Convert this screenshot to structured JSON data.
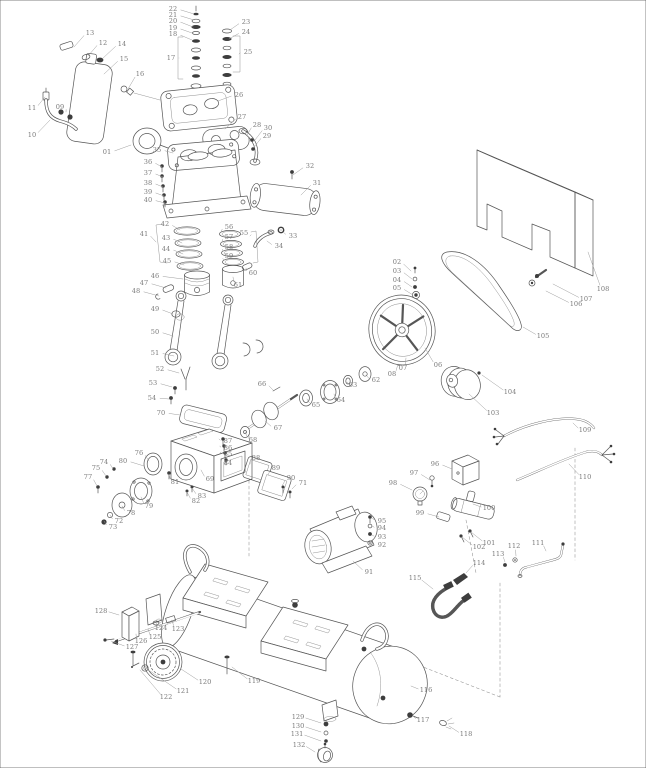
{
  "diagram": {
    "type": "exploded-parts-diagram",
    "part_count": 132
  },
  "style": {
    "line": "#565656",
    "label": "#7b7b7b",
    "leader": "#9d9d9d",
    "background": "#ffffff"
  },
  "parts": [
    {
      "n": "01",
      "x": 107,
      "y": 152,
      "tx": 131,
      "ty": 145
    },
    {
      "n": "02",
      "x": 397,
      "y": 262,
      "tx": 411,
      "ty": 271
    },
    {
      "n": "03",
      "x": 397,
      "y": 271,
      "tx": 412,
      "ty": 279
    },
    {
      "n": "04",
      "x": 397,
      "y": 280,
      "tx": 412,
      "ty": 287
    },
    {
      "n": "05",
      "x": 397,
      "y": 288,
      "tx": 413,
      "ty": 295
    },
    {
      "n": "06",
      "x": 438,
      "y": 365,
      "tx": 425,
      "ty": 348
    },
    {
      "n": "07",
      "x": 403,
      "y": 368,
      "tx": 406,
      "ty": 358
    },
    {
      "n": "08",
      "x": 392,
      "y": 374,
      "tx": 398,
      "ty": 364
    },
    {
      "n": "09",
      "x": 60,
      "y": 107,
      "tx": 66,
      "ty": 112
    },
    {
      "n": "10",
      "x": 32,
      "y": 135,
      "tx": 50,
      "ty": 120
    },
    {
      "n": "11",
      "x": 32,
      "y": 108,
      "tx": 45,
      "ty": 97
    },
    {
      "n": "12",
      "x": 103,
      "y": 43,
      "tx": 88,
      "ty": 56
    },
    {
      "n": "13",
      "x": 90,
      "y": 33,
      "tx": 74,
      "ty": 47
    },
    {
      "n": "14",
      "x": 122,
      "y": 44,
      "tx": 102,
      "ty": 59
    },
    {
      "n": "15",
      "x": 124,
      "y": 59,
      "tx": 104,
      "ty": 74
    },
    {
      "n": "16",
      "x": 140,
      "y": 74,
      "tx": 128,
      "ty": 89
    },
    {
      "n": "17",
      "x": 171,
      "y": 58,
      "tx": 179,
      "ty": 58
    },
    {
      "n": "18",
      "x": 173,
      "y": 34,
      "tx": 192,
      "ty": 40
    },
    {
      "n": "19",
      "x": 173,
      "y": 28,
      "tx": 192,
      "ty": 33
    },
    {
      "n": "20",
      "x": 173,
      "y": 21,
      "tx": 193,
      "ty": 27
    },
    {
      "n": "21",
      "x": 173,
      "y": 15,
      "tx": 194,
      "ty": 20
    },
    {
      "n": "22",
      "x": 173,
      "y": 9,
      "tx": 194,
      "ty": 14
    },
    {
      "n": "23",
      "x": 246,
      "y": 22,
      "tx": 230,
      "ty": 30
    },
    {
      "n": "24",
      "x": 246,
      "y": 32,
      "tx": 229,
      "ty": 39
    },
    {
      "n": "25",
      "x": 248,
      "y": 52,
      "tx": 239,
      "ty": 54
    },
    {
      "n": "26",
      "x": 239,
      "y": 95,
      "tx": 218,
      "ty": 101
    },
    {
      "n": "27",
      "x": 242,
      "y": 117,
      "tx": 225,
      "ty": 129
    },
    {
      "n": "28",
      "x": 257,
      "y": 125,
      "tx": 247,
      "ty": 135
    },
    {
      "n": "29",
      "x": 267,
      "y": 136,
      "tx": 254,
      "ty": 147
    },
    {
      "n": "30",
      "x": 268,
      "y": 128,
      "tx": 255,
      "ty": 140
    },
    {
      "n": "31",
      "x": 317,
      "y": 183,
      "tx": 301,
      "ty": 195
    },
    {
      "n": "32",
      "x": 310,
      "y": 166,
      "tx": 293,
      "ty": 175
    },
    {
      "n": "33",
      "x": 293,
      "y": 236,
      "tx": 282,
      "ty": 231
    },
    {
      "n": "34",
      "x": 279,
      "y": 246,
      "tx": 267,
      "ty": 241
    },
    {
      "n": "35",
      "x": 157,
      "y": 150,
      "tx": 173,
      "ty": 153
    },
    {
      "n": "36",
      "x": 148,
      "y": 162,
      "tx": 162,
      "ty": 167
    },
    {
      "n": "37",
      "x": 148,
      "y": 173,
      "tx": 163,
      "ty": 177
    },
    {
      "n": "38",
      "x": 148,
      "y": 183,
      "tx": 163,
      "ty": 187
    },
    {
      "n": "39",
      "x": 148,
      "y": 192,
      "tx": 164,
      "ty": 196
    },
    {
      "n": "40",
      "x": 148,
      "y": 200,
      "tx": 165,
      "ty": 203
    },
    {
      "n": "41",
      "x": 144,
      "y": 234,
      "tx": 156,
      "ty": 242
    },
    {
      "n": "42",
      "x": 165,
      "y": 224,
      "tx": 180,
      "ty": 230
    },
    {
      "n": "43",
      "x": 166,
      "y": 238,
      "tx": 182,
      "ty": 243
    },
    {
      "n": "44",
      "x": 166,
      "y": 249,
      "tx": 183,
      "ty": 254
    },
    {
      "n": "45",
      "x": 167,
      "y": 261,
      "tx": 184,
      "ty": 265
    },
    {
      "n": "46",
      "x": 155,
      "y": 276,
      "tx": 183,
      "ty": 279
    },
    {
      "n": "47",
      "x": 144,
      "y": 283,
      "tx": 166,
      "ty": 288
    },
    {
      "n": "48",
      "x": 136,
      "y": 291,
      "tx": 159,
      "ty": 296
    },
    {
      "n": "49",
      "x": 155,
      "y": 309,
      "tx": 173,
      "ty": 314
    },
    {
      "n": "50",
      "x": 155,
      "y": 332,
      "tx": 173,
      "ty": 336
    },
    {
      "n": "51",
      "x": 155,
      "y": 353,
      "tx": 174,
      "ty": 356
    },
    {
      "n": "52",
      "x": 160,
      "y": 369,
      "tx": 179,
      "ty": 373
    },
    {
      "n": "53",
      "x": 153,
      "y": 383,
      "tx": 172,
      "ty": 387
    },
    {
      "n": "54",
      "x": 152,
      "y": 398,
      "tx": 169,
      "ty": 399
    },
    {
      "n": "55",
      "x": 244,
      "y": 233,
      "tx": 250,
      "ty": 236
    },
    {
      "n": "56",
      "x": 229,
      "y": 227,
      "tx": 221,
      "ty": 232
    },
    {
      "n": "57",
      "x": 229,
      "y": 237,
      "tx": 222,
      "ty": 242
    },
    {
      "n": "58",
      "x": 229,
      "y": 247,
      "tx": 223,
      "ty": 251
    },
    {
      "n": "59",
      "x": 229,
      "y": 256,
      "tx": 224,
      "ty": 260
    },
    {
      "n": "60",
      "x": 253,
      "y": 273,
      "tx": 246,
      "ty": 268
    },
    {
      "n": "61",
      "x": 238,
      "y": 285,
      "tx": 233,
      "ty": 277
    },
    {
      "n": "62",
      "x": 376,
      "y": 380,
      "tx": 366,
      "ty": 375
    },
    {
      "n": "63",
      "x": 353,
      "y": 385,
      "tx": 348,
      "ty": 382
    },
    {
      "n": "64",
      "x": 341,
      "y": 400,
      "tx": 334,
      "ty": 394
    },
    {
      "n": "65",
      "x": 316,
      "y": 405,
      "tx": 307,
      "ty": 399
    },
    {
      "n": "66",
      "x": 262,
      "y": 384,
      "tx": 273,
      "ty": 390
    },
    {
      "n": "67",
      "x": 278,
      "y": 428,
      "tx": 265,
      "ty": 421
    },
    {
      "n": "68",
      "x": 253,
      "y": 440,
      "tx": 245,
      "ty": 432
    },
    {
      "n": "69",
      "x": 210,
      "y": 479,
      "tx": 201,
      "ty": 470
    },
    {
      "n": "70",
      "x": 161,
      "y": 413,
      "tx": 180,
      "ty": 415
    },
    {
      "n": "71",
      "x": 303,
      "y": 483,
      "tx": 292,
      "ty": 489
    },
    {
      "n": "72",
      "x": 119,
      "y": 521,
      "tx": 110,
      "ty": 515
    },
    {
      "n": "73",
      "x": 113,
      "y": 527,
      "tx": 104,
      "ty": 521
    },
    {
      "n": "74",
      "x": 104,
      "y": 462,
      "tx": 113,
      "ty": 469
    },
    {
      "n": "75",
      "x": 96,
      "y": 468,
      "tx": 106,
      "ty": 476
    },
    {
      "n": "76",
      "x": 139,
      "y": 453,
      "tx": 149,
      "ty": 461
    },
    {
      "n": "77",
      "x": 88,
      "y": 477,
      "tx": 97,
      "ty": 486
    },
    {
      "n": "78",
      "x": 131,
      "y": 513,
      "tx": 122,
      "ty": 506
    },
    {
      "n": "79",
      "x": 149,
      "y": 506,
      "tx": 141,
      "ty": 497
    },
    {
      "n": "80",
      "x": 123,
      "y": 461,
      "tx": 144,
      "ty": 466
    },
    {
      "n": "81",
      "x": 175,
      "y": 482,
      "tx": 169,
      "ty": 474
    },
    {
      "n": "82",
      "x": 196,
      "y": 501,
      "tx": 187,
      "ty": 492
    },
    {
      "n": "83",
      "x": 202,
      "y": 496,
      "tx": 192,
      "ty": 488
    },
    {
      "n": "84",
      "x": 228,
      "y": 463,
      "tx": 222,
      "ty": 459
    },
    {
      "n": "85",
      "x": 228,
      "y": 454,
      "tx": 221,
      "ty": 452
    },
    {
      "n": "86",
      "x": 228,
      "y": 448,
      "tx": 220,
      "ty": 446
    },
    {
      "n": "87",
      "x": 228,
      "y": 441,
      "tx": 219,
      "ty": 439
    },
    {
      "n": "88",
      "x": 256,
      "y": 458,
      "tx": 250,
      "ty": 464
    },
    {
      "n": "89",
      "x": 276,
      "y": 468,
      "tx": 268,
      "ty": 475
    },
    {
      "n": "90",
      "x": 291,
      "y": 478,
      "tx": 282,
      "ty": 486
    },
    {
      "n": "91",
      "x": 369,
      "y": 572,
      "tx": 353,
      "ty": 561
    },
    {
      "n": "92",
      "x": 382,
      "y": 545,
      "tx": 372,
      "ty": 544
    },
    {
      "n": "93",
      "x": 382,
      "y": 537,
      "tx": 372,
      "ty": 535
    },
    {
      "n": "94",
      "x": 382,
      "y": 528,
      "tx": 372,
      "ty": 526
    },
    {
      "n": "95",
      "x": 382,
      "y": 521,
      "tx": 372,
      "ty": 518
    },
    {
      "n": "96",
      "x": 435,
      "y": 464,
      "tx": 452,
      "ty": 469
    },
    {
      "n": "97",
      "x": 414,
      "y": 473,
      "tx": 430,
      "ty": 480
    },
    {
      "n": "98",
      "x": 393,
      "y": 483,
      "tx": 412,
      "ty": 490
    },
    {
      "n": "99",
      "x": 420,
      "y": 513,
      "tx": 439,
      "ty": 517
    },
    {
      "n": "100",
      "x": 489,
      "y": 508,
      "tx": 473,
      "ty": 504
    },
    {
      "n": "101",
      "x": 489,
      "y": 543,
      "tx": 471,
      "ty": 532
    },
    {
      "n": "102",
      "x": 479,
      "y": 547,
      "tx": 462,
      "ty": 537
    },
    {
      "n": "103",
      "x": 493,
      "y": 413,
      "tx": 469,
      "ty": 394
    },
    {
      "n": "104",
      "x": 510,
      "y": 392,
      "tx": 482,
      "ty": 375
    },
    {
      "n": "105",
      "x": 543,
      "y": 336,
      "tx": 523,
      "ty": 327
    },
    {
      "n": "106",
      "x": 576,
      "y": 304,
      "tx": 546,
      "ty": 291
    },
    {
      "n": "107",
      "x": 586,
      "y": 299,
      "tx": 553,
      "ty": 284
    },
    {
      "n": "108",
      "x": 603,
      "y": 289,
      "tx": 588,
      "ty": 252
    },
    {
      "n": "109",
      "x": 585,
      "y": 430,
      "tx": 573,
      "ty": 423
    },
    {
      "n": "110",
      "x": 585,
      "y": 477,
      "tx": 569,
      "ty": 464
    },
    {
      "n": "111",
      "x": 538,
      "y": 543,
      "tx": 546,
      "ty": 551
    },
    {
      "n": "112",
      "x": 514,
      "y": 546,
      "tx": 516,
      "ty": 556
    },
    {
      "n": "113",
      "x": 498,
      "y": 554,
      "tx": 505,
      "ty": 562
    },
    {
      "n": "114",
      "x": 479,
      "y": 563,
      "tx": 466,
      "ty": 573
    },
    {
      "n": "115",
      "x": 415,
      "y": 578,
      "tx": 433,
      "ty": 589
    },
    {
      "n": "116",
      "x": 426,
      "y": 690,
      "tx": 411,
      "ty": 686
    },
    {
      "n": "117",
      "x": 423,
      "y": 720,
      "tx": 413,
      "ty": 716
    },
    {
      "n": "118",
      "x": 466,
      "y": 734,
      "tx": 449,
      "ty": 726
    },
    {
      "n": "119",
      "x": 254,
      "y": 681,
      "tx": 232,
      "ty": 667
    },
    {
      "n": "120",
      "x": 205,
      "y": 682,
      "tx": 181,
      "ty": 669
    },
    {
      "n": "121",
      "x": 183,
      "y": 691,
      "tx": 150,
      "ty": 671
    },
    {
      "n": "122",
      "x": 166,
      "y": 697,
      "tx": 140,
      "ty": 670
    },
    {
      "n": "123",
      "x": 178,
      "y": 629,
      "tx": 172,
      "ty": 620
    },
    {
      "n": "124",
      "x": 161,
      "y": 628,
      "tx": 157,
      "ty": 622
    },
    {
      "n": "125",
      "x": 155,
      "y": 637,
      "tx": 148,
      "ty": 629
    },
    {
      "n": "126",
      "x": 141,
      "y": 641,
      "tx": 136,
      "ty": 634
    },
    {
      "n": "127",
      "x": 132,
      "y": 647,
      "tx": 111,
      "ty": 641
    },
    {
      "n": "128",
      "x": 101,
      "y": 611,
      "tx": 119,
      "ty": 615
    },
    {
      "n": "129",
      "x": 298,
      "y": 717,
      "tx": 321,
      "ty": 723
    },
    {
      "n": "130",
      "x": 298,
      "y": 726,
      "tx": 321,
      "ty": 732
    },
    {
      "n": "131",
      "x": 297,
      "y": 734,
      "tx": 321,
      "ty": 741
    },
    {
      "n": "132",
      "x": 299,
      "y": 745,
      "tx": 315,
      "ty": 752
    }
  ]
}
